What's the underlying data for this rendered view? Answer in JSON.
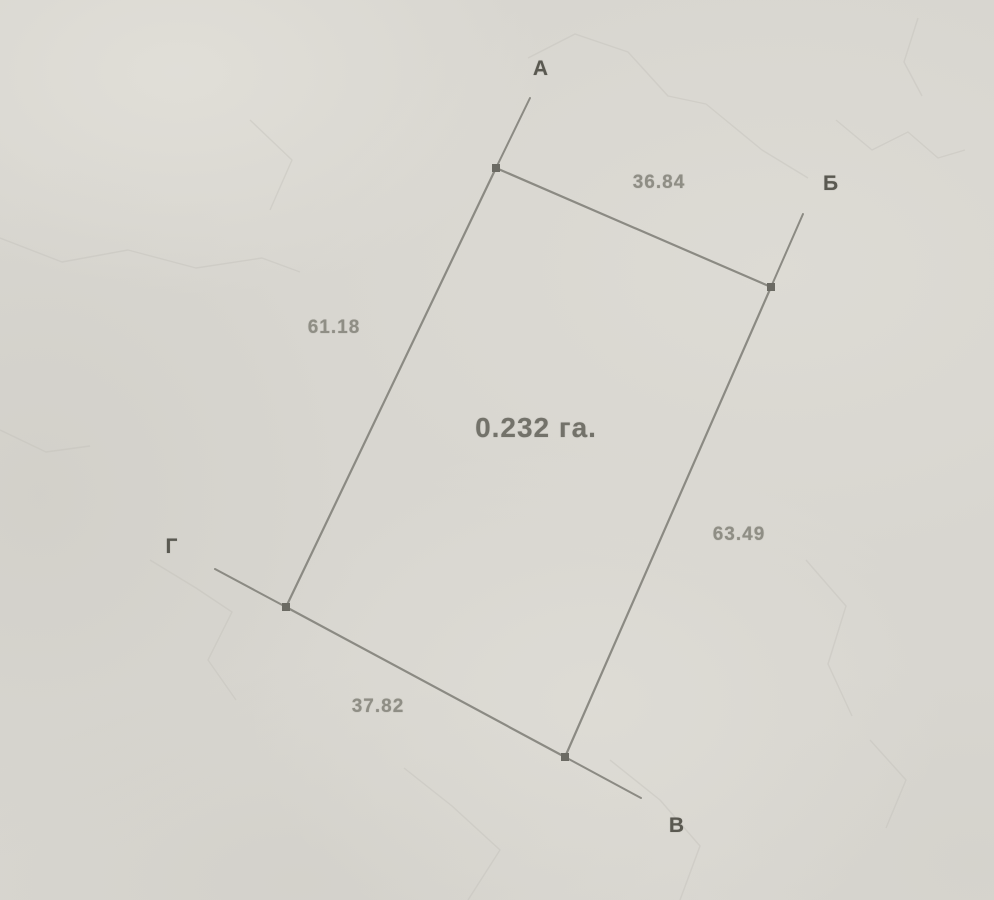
{
  "plan": {
    "type": "land-parcel-survey-sketch",
    "area_label": "0.232 га.",
    "corners": [
      {
        "label": "А"
      },
      {
        "label": "Б"
      },
      {
        "label": "В"
      },
      {
        "label": "Г"
      }
    ],
    "sides": [
      {
        "from": "А",
        "to": "Б",
        "length": "36.84"
      },
      {
        "from": "Б",
        "to": "В",
        "length": "63.49"
      },
      {
        "from": "Г",
        "to": "В",
        "length": "37.82"
      },
      {
        "from": "А",
        "to": "Г",
        "length": "61.18"
      }
    ],
    "colors": {
      "paper": "#d8d6d0",
      "boundary_line": "#8b8a83",
      "corner_point": "#6b6a63",
      "measure_text": "#8f8e85",
      "corner_text": "#5a5951",
      "area_text": "#73726a"
    }
  }
}
